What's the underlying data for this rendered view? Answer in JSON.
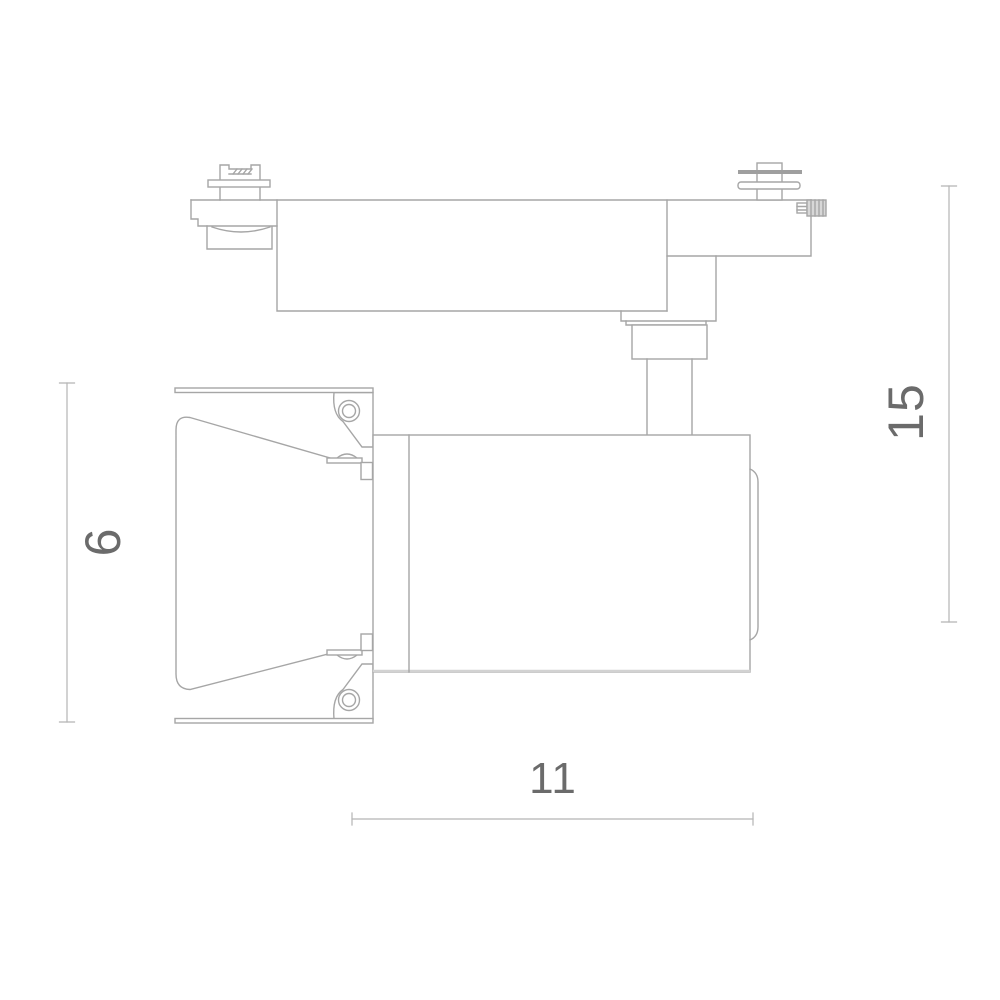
{
  "drawing": {
    "type": "technical-dimension-drawing",
    "subject": "track-light-fixture-side-view",
    "background": "#ffffff",
    "colors": {
      "line": "#a6a6a6",
      "soft_line": "#d2d2d2",
      "dim_line": "#b5b5b5",
      "dim_text": "#6b6b6b",
      "washer_fill": "#9f9f9f",
      "knob_fill": "#d7d7d7",
      "knob_stroke": "#8f8f8f"
    },
    "dimensions": {
      "left_vertical": {
        "value": "6"
      },
      "right_vertical": {
        "value": "15"
      },
      "bottom_horizontal": {
        "value": "11"
      }
    }
  }
}
